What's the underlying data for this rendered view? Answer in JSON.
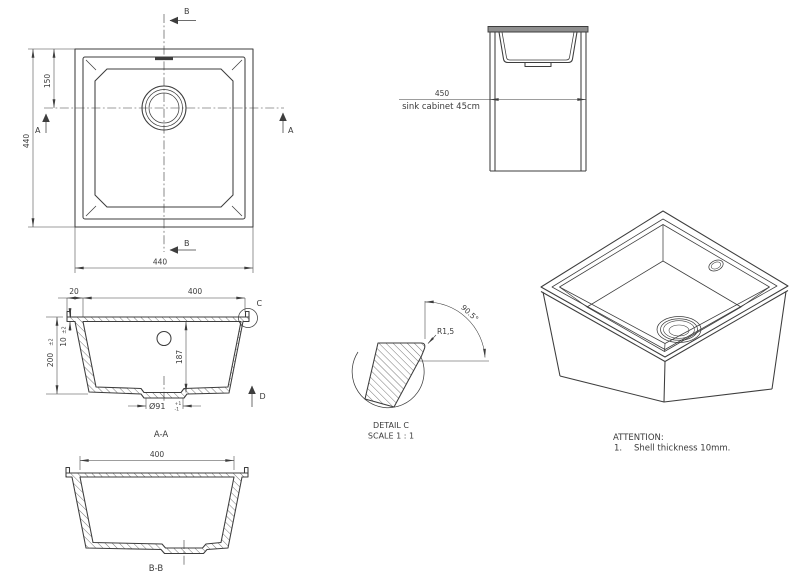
{
  "colors": {
    "line": "#3d3d3d",
    "ink": "#3b3b3b",
    "background": "#ffffff",
    "slab": "#8f8f8f"
  },
  "plan_view": {
    "dim_width_overall": "440",
    "dim_height_overall": "440",
    "dim_drain_offset": "150",
    "marker_a": "A",
    "marker_b": "B"
  },
  "cabinet_view": {
    "dim_width": "450",
    "caption": "sink cabinet 45cm"
  },
  "section_aa": {
    "label": "A-A",
    "dim_bowl_width": "400",
    "dim_rim_overhang": "20",
    "dim_overall_height": "200",
    "dim_overall_height_tol": "±2",
    "dim_shell_thickness": "10",
    "dim_shell_thickness_tol": "±2",
    "dim_bowl_depth": "187",
    "dim_drain_diameter": "Ø91",
    "dim_drain_tol_plus": "+1",
    "dim_drain_tol_minus": "-1",
    "detail_marker": "C",
    "direction_marker": "D"
  },
  "detail_c": {
    "name": "DETAIL C",
    "scale": "SCALE 1 : 1",
    "radius": "R1,5",
    "angle": "90.5°"
  },
  "section_bb": {
    "label": "B-B",
    "dim_bowl_width": "400"
  },
  "attention": {
    "title": "ATTENTION:",
    "item_number": "1.",
    "item_text": "Shell thickness 10mm."
  }
}
